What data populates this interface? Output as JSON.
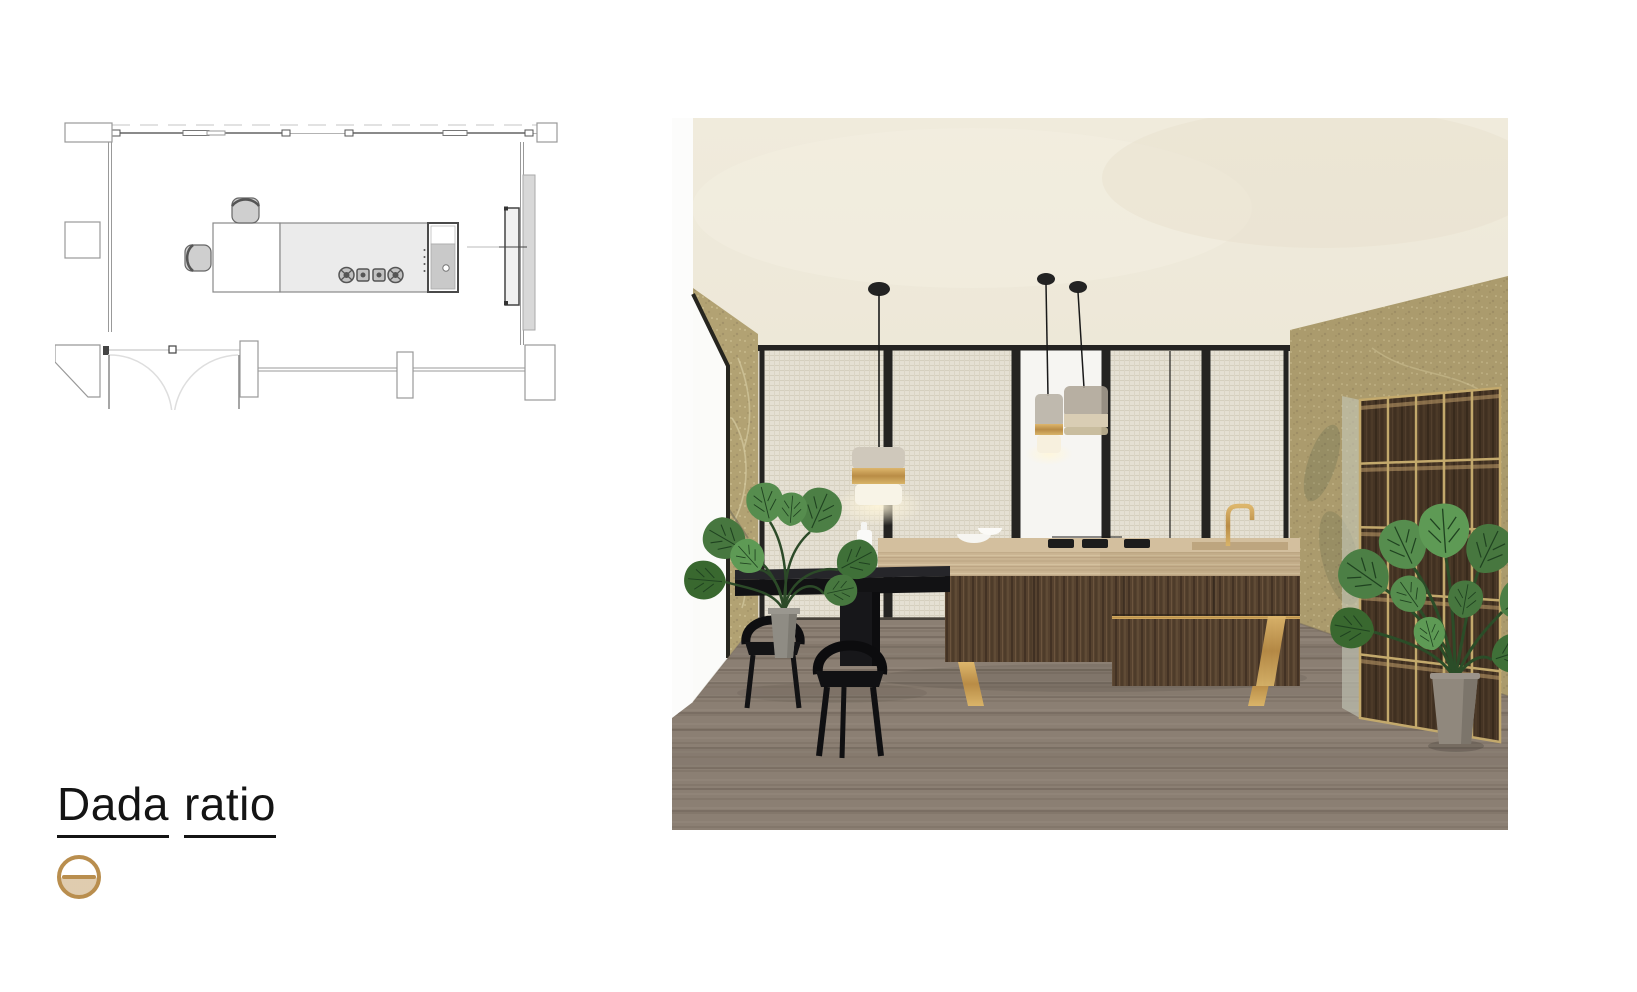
{
  "page": {
    "width": 1637,
    "height": 992,
    "background": "#ffffff"
  },
  "brand": {
    "word1": "Dada",
    "word2": "ratio"
  },
  "logo": {
    "name": "dada-circle-mark",
    "shape": "circle-with-horizontal-bar"
  },
  "colors": {
    "page_bg": "#ffffff",
    "ink": "#141414",
    "gold": "#b98e4e",
    "ceiling": "#ece6d7",
    "linen_panel": "#e5e0d3",
    "panel_frame": "#242321",
    "white_panel": "#f6f5f2",
    "wall_gold": "#b2a273",
    "floor_wood": "#8b7f73",
    "floor_line": "#675d52",
    "travertine": "#c9b391",
    "cabinet_wood": "#56422f",
    "brass": "#c49d58",
    "black_furniture": "#141416",
    "leaf_green": "#4c7f45",
    "pot_gray": "#8f8c84",
    "plan_line": "#9a9a9a",
    "plan_dark": "#4a4a4a"
  },
  "floor_plan": {
    "name": "kitchen-plan-drawing",
    "elements": [
      "exterior-walls",
      "window-band",
      "entry-double-door",
      "kitchen-island",
      "dining-extension",
      "two-chairs",
      "cooktop-4-burners",
      "sink-appliance-unit",
      "tall-side-unit"
    ]
  },
  "render": {
    "name": "kitchen-interior-render",
    "elements": [
      "textured-ceiling",
      "linen-glass-partition",
      "white-center-panel",
      "gold-wallpaper-walls",
      "left-window",
      "travertine-island",
      "dark-wood-cabinets",
      "brass-legs",
      "black-dining-table",
      "two-black-chairs",
      "disc-pendant-light",
      "two-glass-pendant-lights",
      "monstera-plant-left",
      "monstera-plant-right",
      "backlit-grid-shelving",
      "wood-plank-floor",
      "gold-faucet",
      "white-bowls",
      "white-bottle"
    ]
  }
}
